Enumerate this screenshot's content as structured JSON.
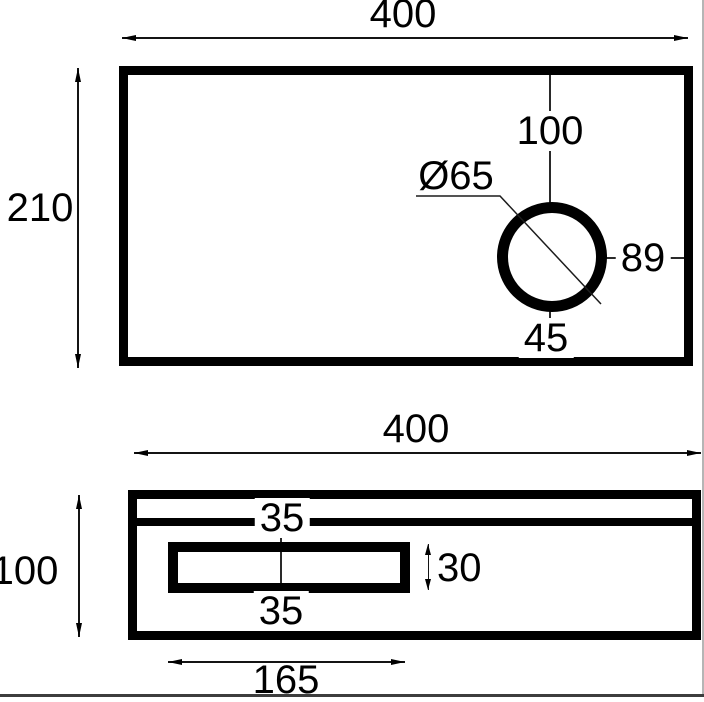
{
  "colors": {
    "line": "#000000",
    "background": "#ffffff"
  },
  "top_view": {
    "width": "400",
    "height": "210",
    "hole_diameter": "Ø65",
    "hole_offset_top": "100",
    "hole_offset_right": "89",
    "hole_offset_bottom": "45"
  },
  "bottom_view": {
    "width": "400",
    "height": "100",
    "groove_offset": "35",
    "slot_height": "30",
    "slot_offset": "35",
    "slot_length": "165"
  }
}
